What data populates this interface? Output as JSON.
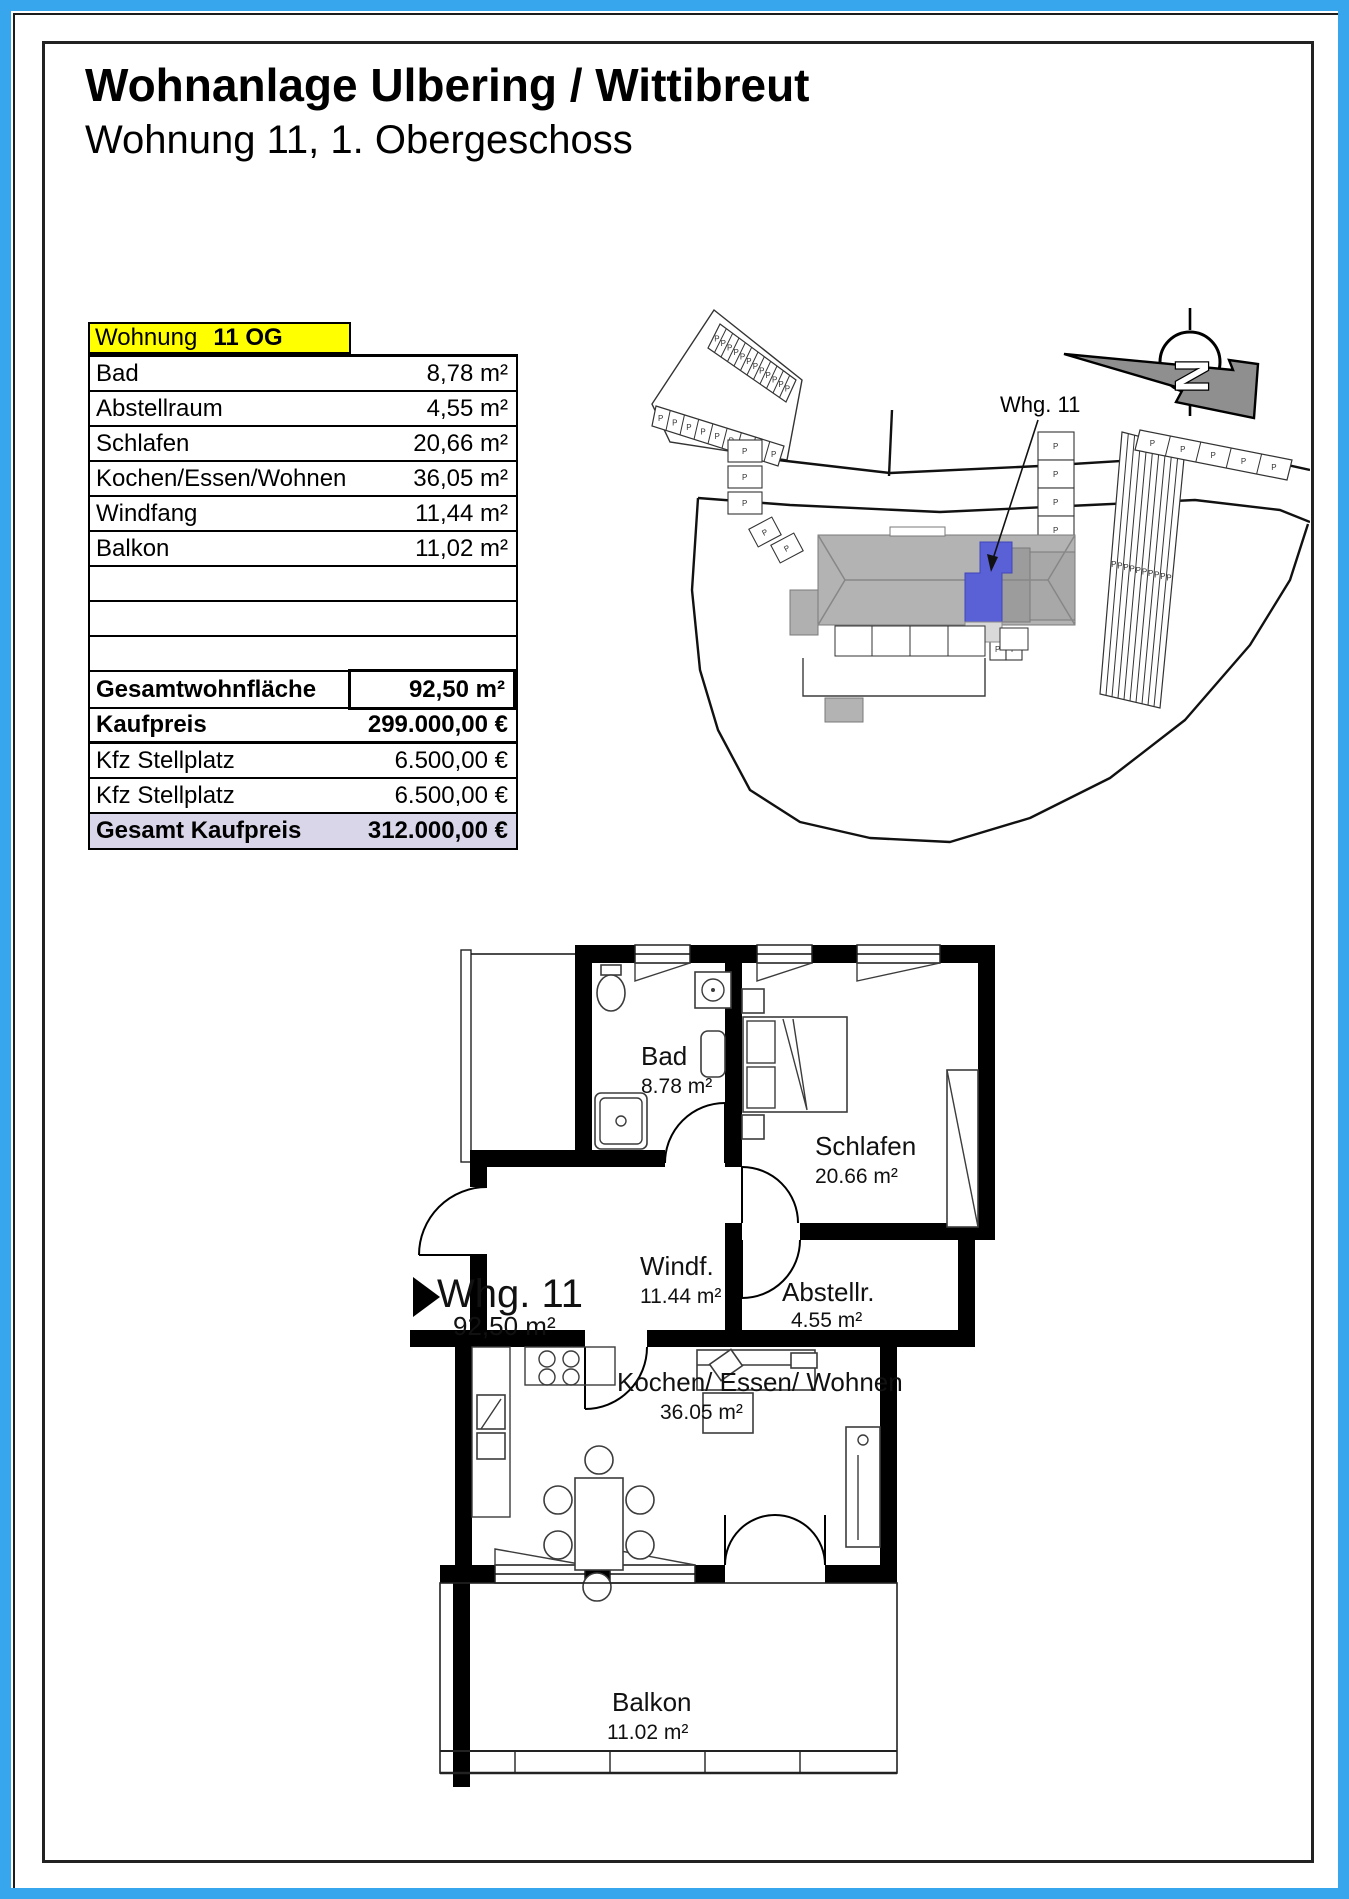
{
  "header": {
    "title": "Wohnanlage Ulbering / Wittibreut",
    "subtitle": "Wohnung 11, 1. Obergeschoss"
  },
  "table": {
    "header_label": "Wohnung",
    "header_value": "11 OG",
    "rows": [
      {
        "label": "Bad",
        "value": "8,78 m²"
      },
      {
        "label": "Abstellraum",
        "value": "4,55 m²"
      },
      {
        "label": "Schlafen",
        "value": "20,66 m²"
      },
      {
        "label": "Kochen/Essen/Wohnen",
        "value": "36,05 m²"
      },
      {
        "label": "Windfang",
        "value": "11,44 m²"
      },
      {
        "label": "Balkon",
        "value": "11,02 m²"
      }
    ],
    "total_area_label": "Gesamtwohnfläche",
    "total_area_value": "92,50 m²",
    "kaufpreis_label": "Kaufpreis",
    "kaufpreis_value": "299.000,00 €",
    "stellplatz1_label": "Kfz Stellplatz",
    "stellplatz1_value": "6.500,00 €",
    "stellplatz2_label": "Kfz Stellplatz",
    "stellplatz2_value": "6.500,00 €",
    "gesamt_label": "Gesamt Kaufpreis",
    "gesamt_value": "312.000,00 €"
  },
  "site_plan": {
    "unit_label": "Whg. 11",
    "north_letter": "N",
    "parking_letter": "P",
    "highlight_color": "#5a60d6"
  },
  "floor_plan": {
    "apartment_label": "Whg. 11",
    "apartment_area": "92,50 m²",
    "bad_name": "Bad",
    "bad_area": "8.78 m²",
    "schlafen_name": "Schlafen",
    "schlafen_area": "20.66 m²",
    "windfang_name": "Windf.",
    "windfang_area": "11.44 m²",
    "abstell_name": "Abstellr.",
    "abstell_area": "4.55 m²",
    "wohnen_name": "Kochen/ Essen/ Wohnen",
    "wohnen_area": "36.05 m²",
    "balkon_name": "Balkon",
    "balkon_area": "11.02 m²"
  },
  "colors": {
    "frame_blue": "#38a6ec",
    "header_yellow": "#ffff00",
    "total_row_bg": "#dad6e9",
    "unit_blue": "#5a60d6"
  }
}
